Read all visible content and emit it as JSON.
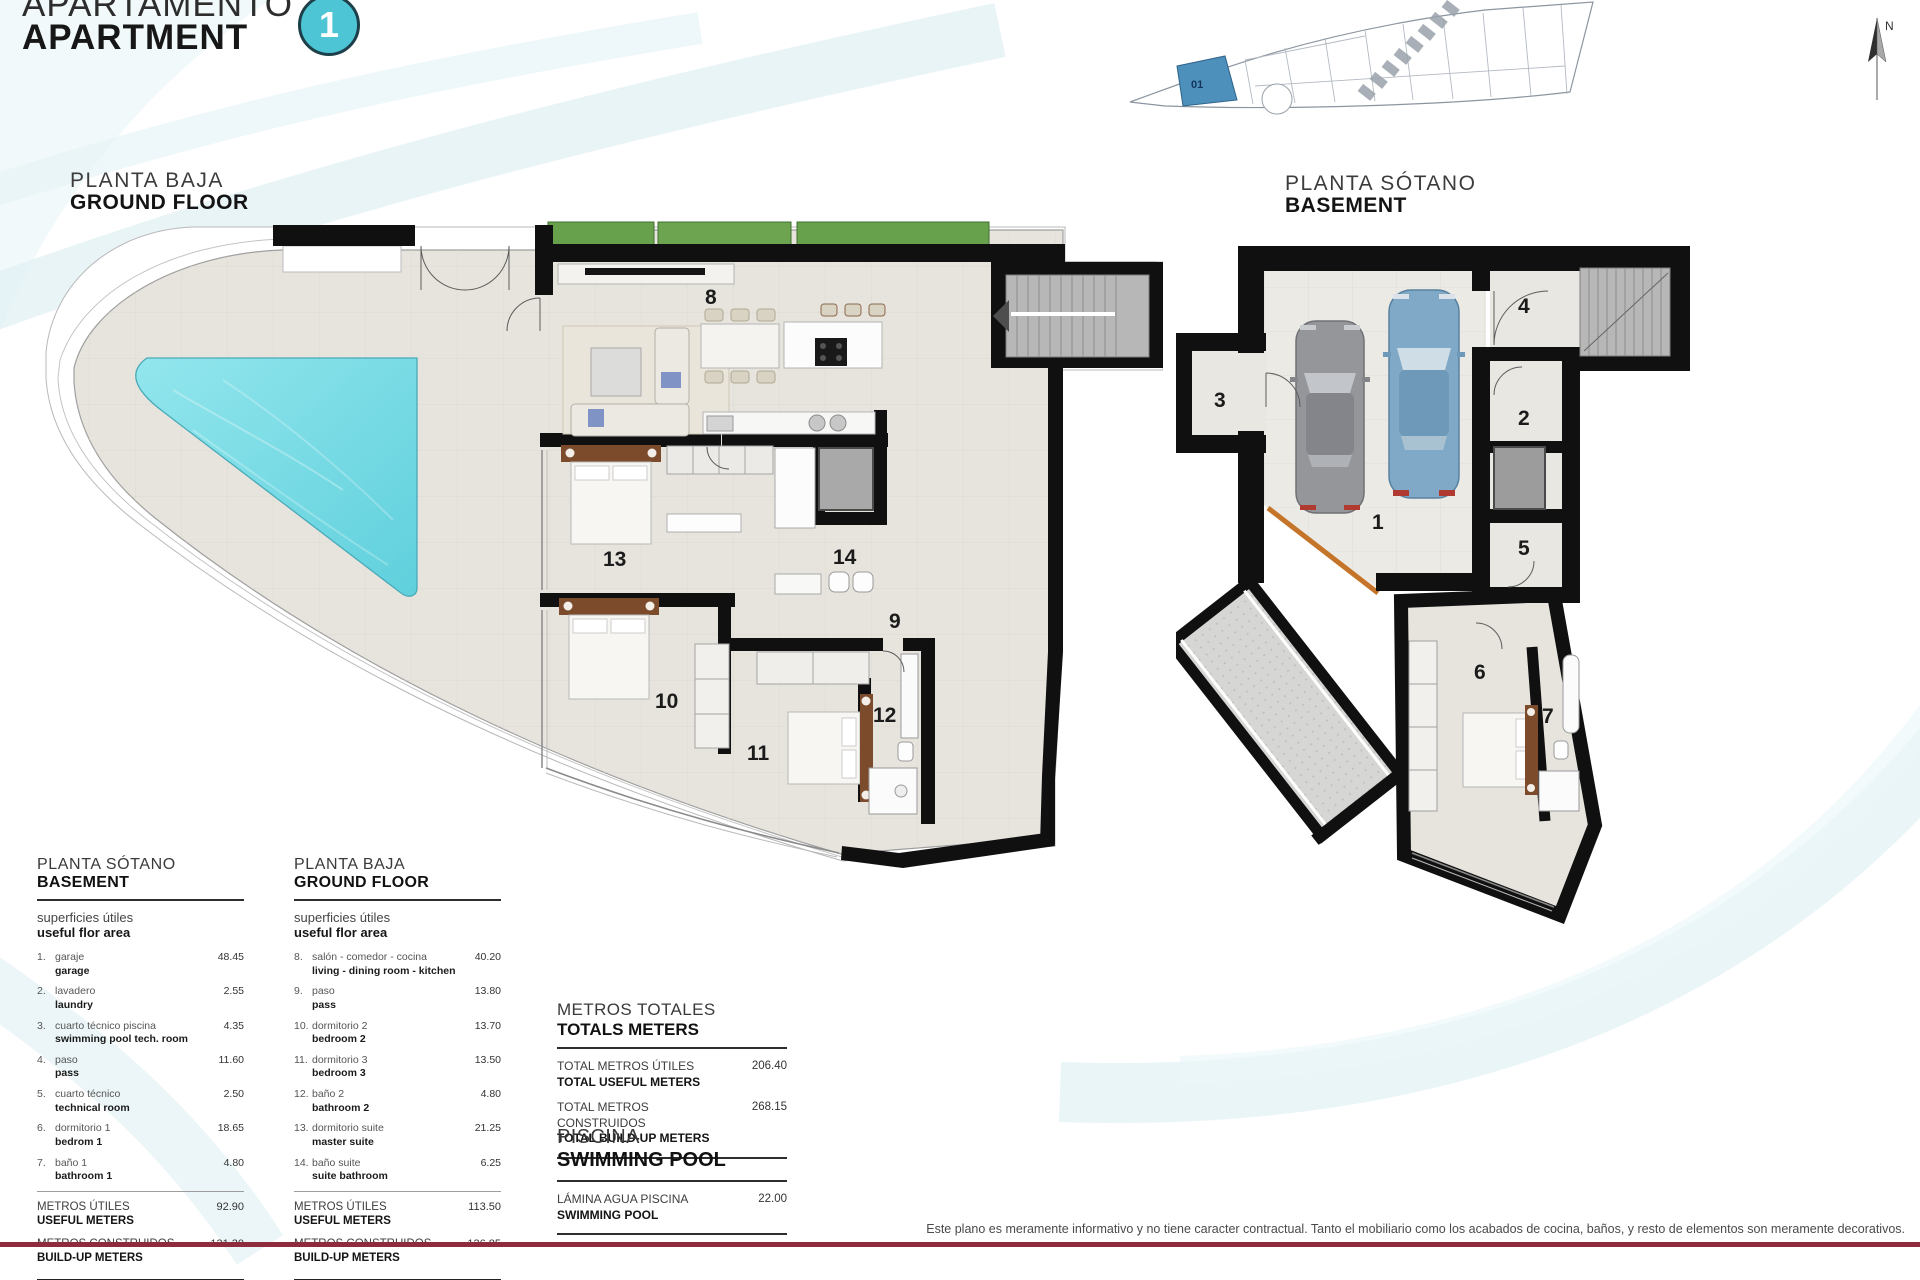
{
  "header": {
    "title_line1": "APARTAMENTO",
    "title_line2": "APARTMENT",
    "unit_number": "1"
  },
  "site_plan": {
    "unit_label": "01",
    "north_label": "N",
    "highlight_color": "#4e90bc"
  },
  "ground_plan": {
    "label_line1": "PLANTA BAJA",
    "label_line2": "GROUND FLOOR",
    "room_numbers": [
      "8",
      "9",
      "10",
      "11",
      "12",
      "13",
      "14"
    ]
  },
  "basement_plan": {
    "label_line1": "PLANTA SÓTANO",
    "label_line2": "BASEMENT",
    "room_numbers": [
      "1",
      "2",
      "3",
      "4",
      "5",
      "6",
      "7"
    ]
  },
  "legend_basement": {
    "title_line1": "PLANTA SÓTANO",
    "title_line2": "BASEMENT",
    "subtitle_line1": "superficies útiles",
    "subtitle_line2": "useful flor area",
    "rows": [
      {
        "num": "1.",
        "es": "garaje",
        "en": "garage",
        "value": "48.45"
      },
      {
        "num": "2.",
        "es": "lavadero",
        "en": "laundry",
        "value": "2.55"
      },
      {
        "num": "3.",
        "es": "cuarto técnico piscina",
        "en": "swimming pool tech. room",
        "value": "4.35"
      },
      {
        "num": "4.",
        "es": "paso",
        "en": "pass",
        "value": "11.60"
      },
      {
        "num": "5.",
        "es": "cuarto técnico",
        "en": "technical room",
        "value": "2.50"
      },
      {
        "num": "6.",
        "es": "dormitorio 1",
        "en": "bedrom 1",
        "value": "18.65"
      },
      {
        "num": "7.",
        "es": "baño 1",
        "en": "bathroom 1",
        "value": "4.80"
      }
    ],
    "totals": [
      {
        "es": "METROS ÚTILES",
        "en": "USEFUL METERS",
        "value": "92.90"
      },
      {
        "es": "METROS CONSTRUIDOS",
        "en": "BUILD-UP METERS",
        "value": "131.30"
      }
    ]
  },
  "legend_ground": {
    "title_line1": "PLANTA BAJA",
    "title_line2": "GROUND FLOOR",
    "subtitle_line1": "superficies útiles",
    "subtitle_line2": "useful flor area",
    "rows": [
      {
        "num": "8.",
        "es": "salón - comedor - cocina",
        "en": "living - dining room - kitchen",
        "value": "40.20"
      },
      {
        "num": "9.",
        "es": "paso",
        "en": "pass",
        "value": "13.80"
      },
      {
        "num": "10.",
        "es": "dormitorio 2",
        "en": "bedroom 2",
        "value": "13.70"
      },
      {
        "num": "11.",
        "es": "dormitorio 3",
        "en": "bedroom 3",
        "value": "13.50"
      },
      {
        "num": "12.",
        "es": "baño 2",
        "en": "bathroom 2",
        "value": "4.80"
      },
      {
        "num": "13.",
        "es": "dormitorio suite",
        "en": "master suite",
        "value": "21.25"
      },
      {
        "num": "14.",
        "es": "baño suite",
        "en": "suite bathroom",
        "value": "6.25"
      }
    ],
    "totals": [
      {
        "es": "METROS ÚTILES",
        "en": "USEFUL METERS",
        "value": "113.50"
      },
      {
        "es": "METROS CONSTRUIDOS",
        "en": "BUILD-UP METERS",
        "value": "136.85"
      }
    ]
  },
  "totals_block": {
    "title_line1": "METROS TOTALES",
    "title_line2": "TOTALS METERS",
    "rows": [
      {
        "es": "TOTAL METROS ÚTILES",
        "en": "TOTAL USEFUL METERS",
        "value": "206.40"
      },
      {
        "es": "TOTAL METROS CONSTRUIDOS",
        "en": "TOTAL BUILD-UP METERS",
        "value": "268.15"
      }
    ]
  },
  "pool_block": {
    "title_line1": "PISCINA",
    "title_line2": "SWIMMING POOL",
    "rows": [
      {
        "es": "LÁMINA AGUA PISCINA",
        "en": "SWIMMING POOL",
        "value": "22.00"
      }
    ]
  },
  "footer": {
    "disclaimer": "Este plano es meramente informativo y no tiene caracter contractual. Tanto el mobiliario como los acabados de cocina, baños, y resto de elementos son meramente decorativos."
  },
  "colors": {
    "accent_teal": "#4ec5d4",
    "pool_water": "#7bdce6",
    "wall_black": "#101010",
    "floor_beige": "#e7e4dd",
    "grass_green": "#67a14b",
    "maroon_line": "#8e2b3c",
    "site_highlight": "#4e90bc"
  }
}
